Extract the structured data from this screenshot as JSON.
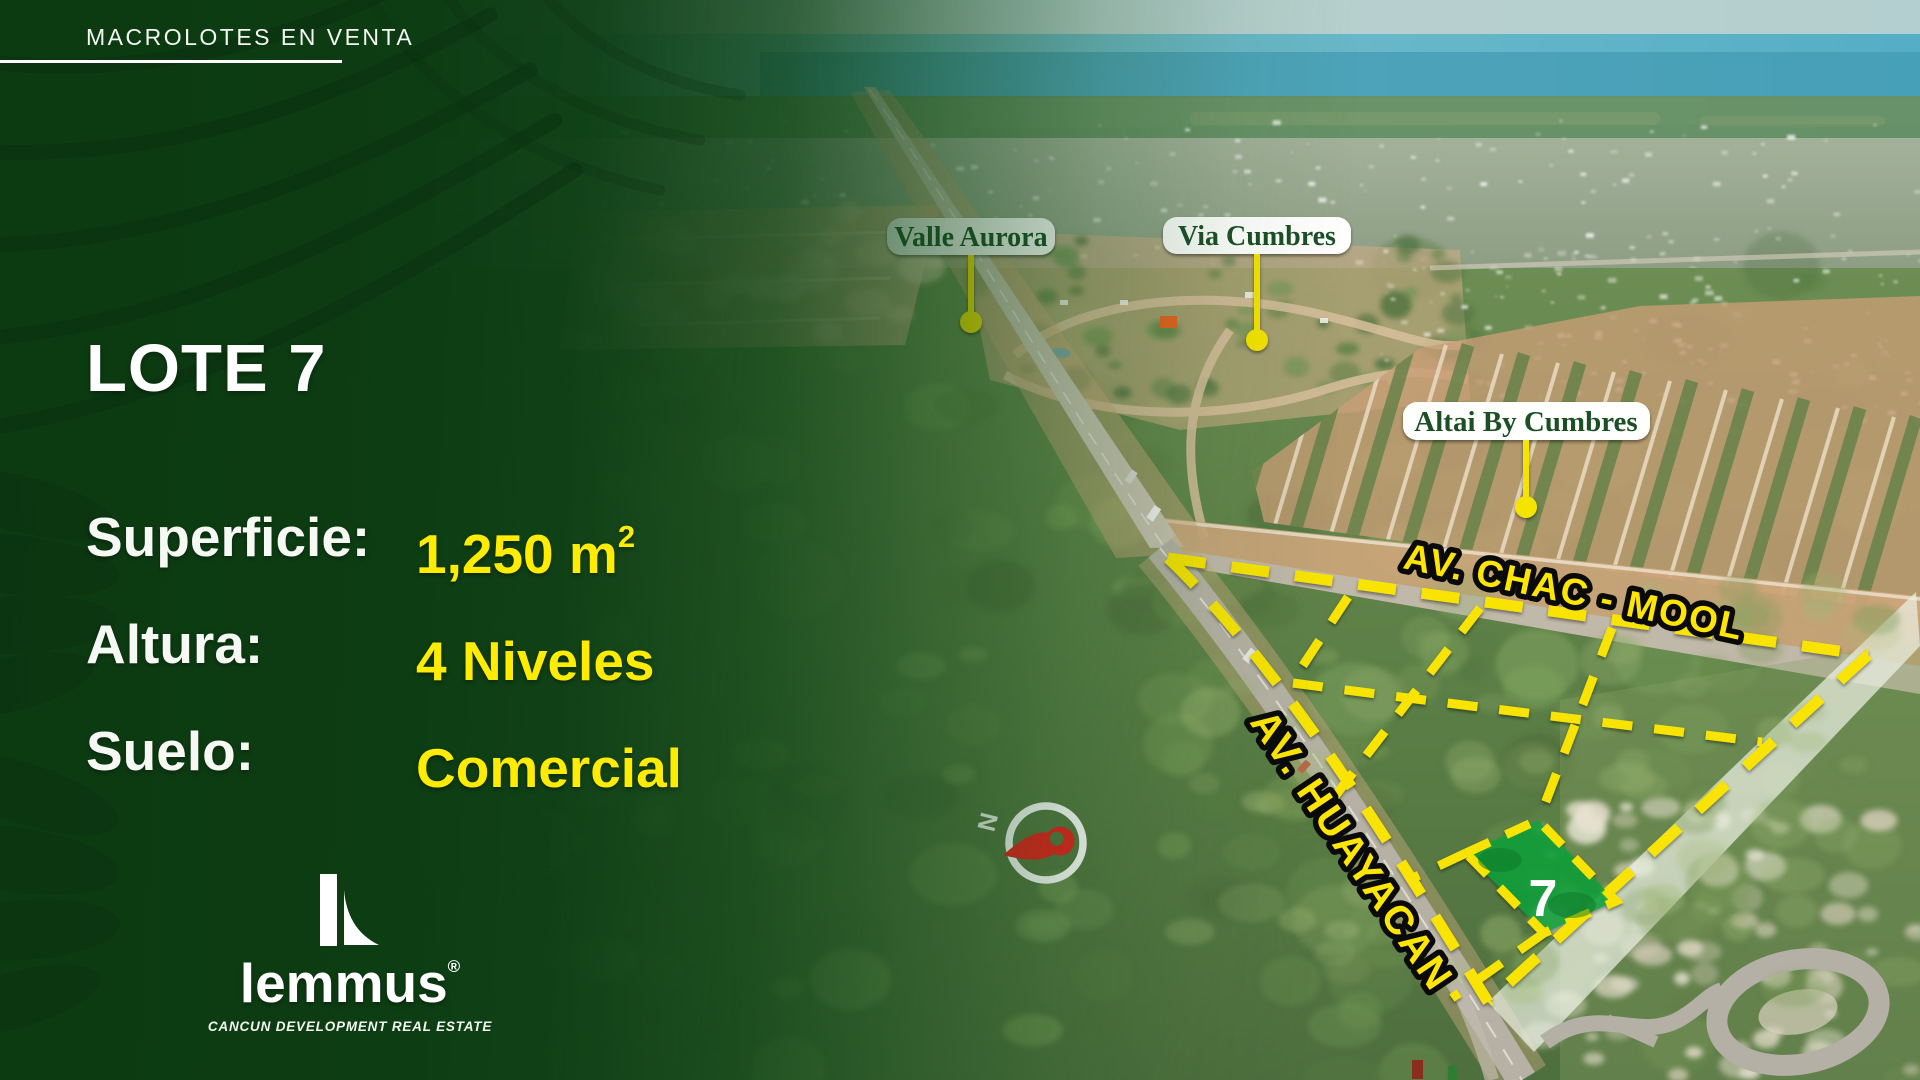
{
  "header": {
    "kicker": "MACROLOTES EN VENTA"
  },
  "lot": {
    "title": "LOTE 7",
    "number": "7"
  },
  "specs": [
    {
      "label": "Superficie:",
      "value": "1,250 m",
      "sup": "2"
    },
    {
      "label": "Altura:",
      "value": "4 Niveles",
      "sup": ""
    },
    {
      "label": "Suelo:",
      "value": "Comercial",
      "sup": ""
    }
  ],
  "logo": {
    "brand": "lemmus",
    "registered": "®",
    "tagline": "CANCUN DEVELOPMENT REAL ESTATE"
  },
  "map": {
    "labels": [
      {
        "text": "Valle Aurora"
      },
      {
        "text": "Via Cumbres"
      },
      {
        "text": "Altai By Cumbres"
      }
    ],
    "streets": [
      {
        "text": "AV.  CHAC - MOOL"
      },
      {
        "text": "AV. HUAYACAN"
      }
    ],
    "lot_marker": "7",
    "compass": "N"
  },
  "colors": {
    "accent_yellow": "#f8e400",
    "value_yellow": "#ffec00",
    "overlay_green": "#0d3a12",
    "label_green": "#1d5026",
    "lot_green": "#0da23c",
    "needle_red": "#e8201e"
  }
}
